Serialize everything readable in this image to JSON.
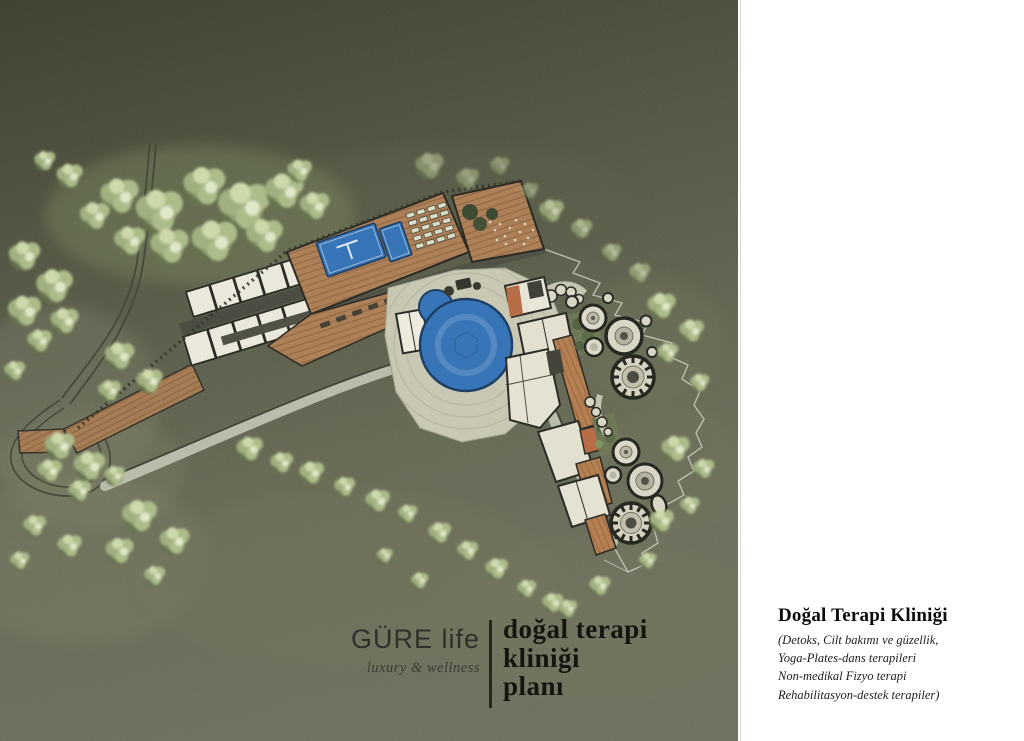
{
  "logo": {
    "brand": "GÜRE life",
    "tagline": "luxury & wellness"
  },
  "plan_title": {
    "lines": [
      "doğal terapi",
      "kliniği",
      "planı"
    ]
  },
  "annotation": {
    "title": "Doğal Terapi Kliniği",
    "lines": [
      "(Detoks, Cilt bakımı ve güzellik,",
      "Yoga-Plates-dans terapileri",
      "Non-medikal Fizyo terapi",
      "Rehabilitasyon-destek terapiler)"
    ]
  },
  "site_plan": {
    "features": [
      "terrain",
      "forest-trees",
      "access-road",
      "hairpin-turn",
      "timber-boardwalk",
      "guest-room-block",
      "pool-deck",
      "lap-pool",
      "small-pool",
      "sun-loungers",
      "roof-terrace",
      "central-round-pool",
      "plaza",
      "therapy-building-cluster",
      "domed-pavilions-north",
      "domed-pavilions-south",
      "courtyard-gardens",
      "promenade-path",
      "site-boundary"
    ]
  },
  "palette": {
    "terrain_dark": "#3c402e",
    "terrain_light": "#6b6d5b",
    "tree_green": "#a9ba85",
    "wood_deck": "#ab7b51",
    "pool_blue": "#2f6fb5",
    "building_cream": "#e7e5d6",
    "terracotta": "#b4683f",
    "path_light": "#b7baa8",
    "ink": "#23231d",
    "panel_white": "#ffffff"
  }
}
